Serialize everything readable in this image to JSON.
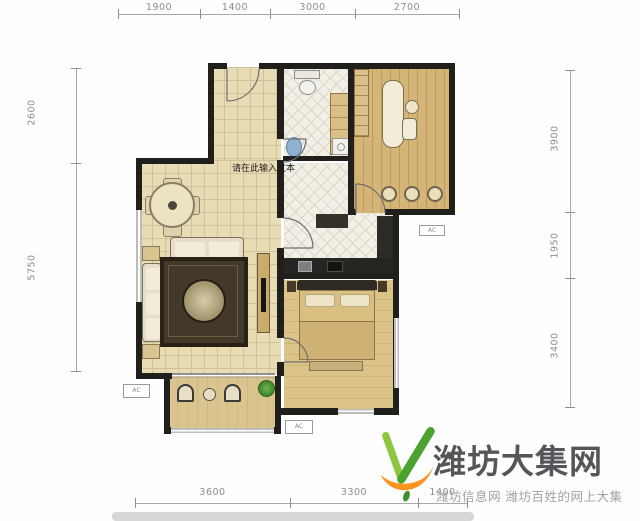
{
  "dims": {
    "top": {
      "segments": [
        {
          "label": "1900"
        },
        {
          "label": "1400"
        },
        {
          "label": "3000"
        },
        {
          "label": "2700"
        }
      ]
    },
    "bottom": {
      "segments": [
        {
          "label": "3600"
        },
        {
          "label": "3300"
        },
        {
          "label": "1400"
        }
      ]
    },
    "left": {
      "segments": [
        {
          "label": "2600"
        },
        {
          "label": "5750"
        }
      ]
    },
    "right": {
      "segments": [
        {
          "label": "3900"
        },
        {
          "label": "1950"
        },
        {
          "label": "3400"
        }
      ]
    }
  },
  "plan": {
    "placeholder_text": "请在此输入文本",
    "ac_label": "AC",
    "colors": {
      "wall": "#211f1c",
      "tile_floor": "#e8dcb4",
      "wood_floor": "#d5b477",
      "bedroom_floor": "#dcc488",
      "bath_tile": "#f2efe7",
      "counter": "#272522",
      "rug": "#43392a",
      "sink_blue": "#8fb3cf",
      "plant_green": "#4f9a3a",
      "window_gray": "#bcbcbc",
      "dimension_text": "#8c8c8c"
    }
  },
  "watermark": {
    "title": "潍坊大集网",
    "subtitle": "潍坊信息网 潍坊百姓的网上大集",
    "brand_green_light": "#8dc63f",
    "brand_green_dark": "#4ba22e",
    "brand_orange": "#f7941d",
    "title_color": "#55565a",
    "subtitle_color": "#a2a2a2"
  }
}
